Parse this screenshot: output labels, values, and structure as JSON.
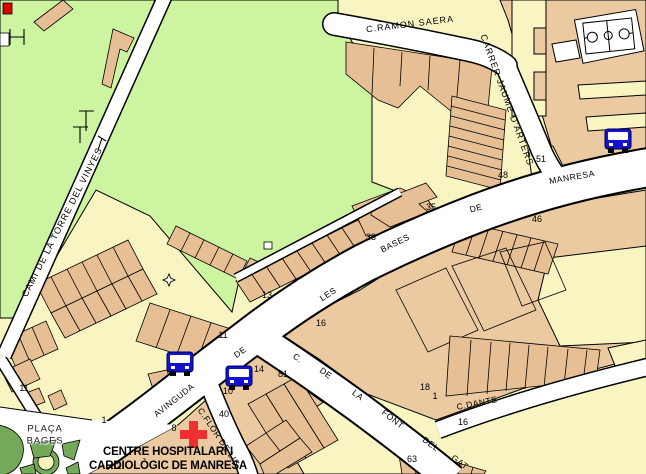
{
  "map": {
    "hospital_label": {
      "line1": "CENTRE HOSPITALARI I",
      "line2": "CARDIOLÒGIC DE MANRESA"
    },
    "streets": {
      "cami_torre": "CAMI DE LA TORRE DEL VINYES",
      "ramon_saera": "C.RAMON SAERA",
      "jaume_arters": "CARRER JAUME D'ARTERS",
      "avenue_words": [
        "AVINGUDA",
        "DE",
        "LES",
        "BASES",
        "DE",
        "MANRESA"
      ],
      "font_gat_words": [
        "C.",
        "DE",
        "LA",
        "FONT",
        "DEL",
        "GAT"
      ],
      "dante": "C.DANTE",
      "flor_de_lis": "C.FLOR DE LIS",
      "placa_bages_line1": "PLAÇA",
      "placa_bages_line2": "BAGES"
    },
    "house_numbers": [
      "51",
      "48",
      "46",
      "35",
      "33",
      "13",
      "16",
      "11",
      "11",
      "10",
      "14",
      "81",
      "40",
      "1",
      "8",
      "18",
      "1",
      "16",
      "63",
      "2"
    ],
    "icons": {
      "bus": "bus-stop",
      "hospital_cross": "hospital",
      "sports_court": "basketball-court",
      "landmark": "star-landmark",
      "red_marker": "red-marker"
    },
    "colors": {
      "park": "#ccf4a1",
      "plaza_green": "#74a95a",
      "block_cream": "#f8f5c3",
      "block_tan": "#ebc9a1",
      "building_tan": "#e7bf94",
      "road": "#ffffff",
      "outline": "#000000",
      "bus_blue": "#1212cf",
      "cross_red": "#f03030",
      "marker_red": "#e00000"
    }
  }
}
